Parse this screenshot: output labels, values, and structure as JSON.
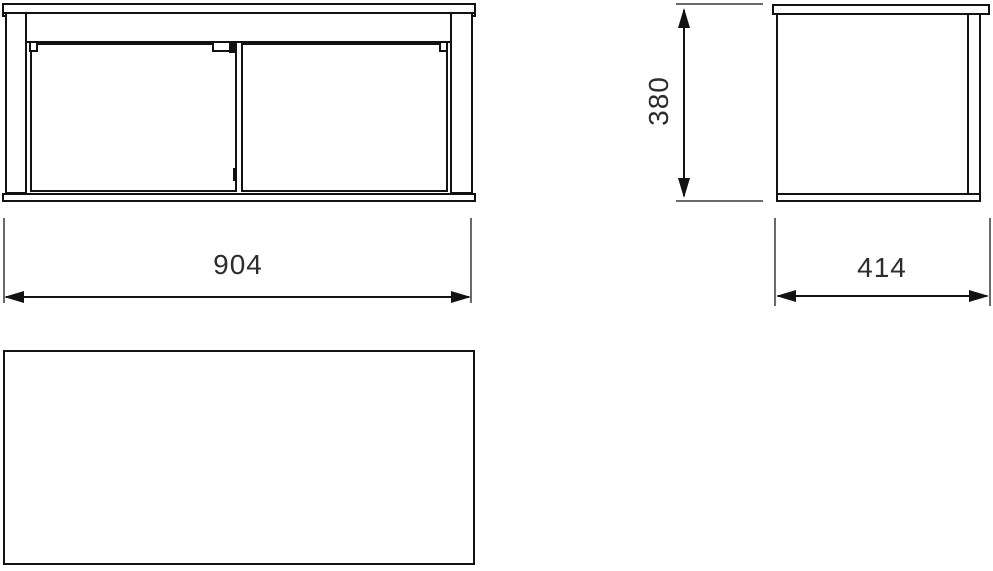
{
  "drawing": {
    "dimensions": {
      "width": {
        "value": "904",
        "orientation": "horizontal",
        "applies_to": "front-view"
      },
      "height": {
        "value": "380",
        "orientation": "vertical",
        "applies_to": "side-view"
      },
      "depth": {
        "value": "414",
        "orientation": "horizontal",
        "applies_to": "side-view"
      }
    },
    "colors": {
      "outline": "#121212",
      "extension_line": "#6a6a6a",
      "dimension_text": "#2d2d2d",
      "background": "#ffffff"
    }
  }
}
